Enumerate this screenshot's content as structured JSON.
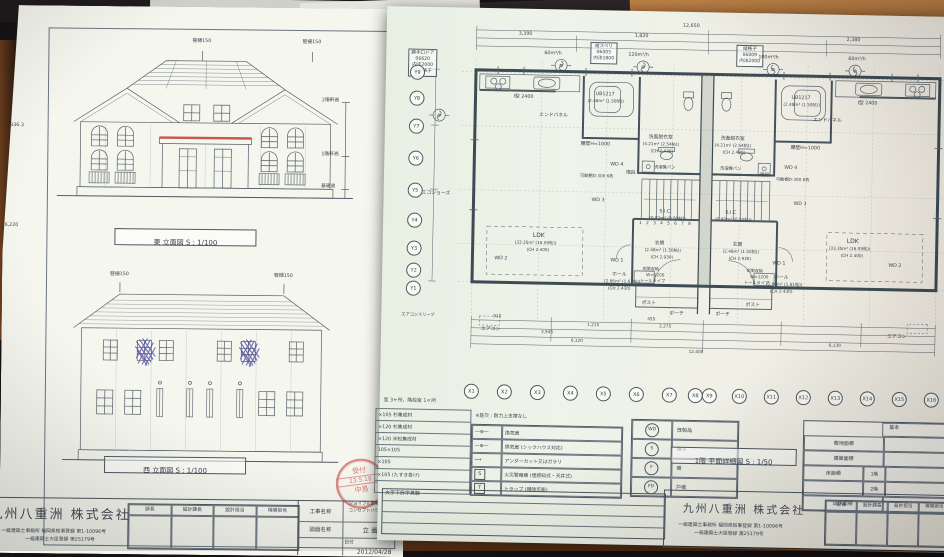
{
  "left": {
    "levels": {
      "lv1": "6,336.3",
      "lv2": "6,220"
    },
    "downspout": "竪樋150",
    "east_title": "東  立面図   S : 1/100",
    "west_title": "西  立面図   S : 1/100",
    "h2": "2階軒高",
    "h1": "1階軒高",
    "hb": "基礎高",
    "stamp": {
      "l1": "受付",
      "l2": "23.5.18",
      "l3": "中島"
    },
    "tb": {
      "company": "九州八重洲 株式会社",
      "reg1": "一級建築士事務所  福岡県知事登録  第1-10096号",
      "reg2": "一級建築士大臣登録  第25179号",
      "r1": "部長",
      "r2": "設計課長",
      "r3": "設計担当",
      "r4": "現場担当",
      "pl": "工事名称",
      "p1": "ジョイフル新築",
      "p1h": "東欧の丘",
      "p2": "コンセプトハウス",
      "p2h": "NO 27",
      "dl": "図面名称",
      "dn": "立 面 図",
      "datel": "日付",
      "date": "2012/04/28"
    }
  },
  "right": {
    "plan_title": "1階  平面詳細図  S : 1/50",
    "gx": [
      "X1",
      "X2",
      "X3",
      "X4",
      "X5",
      "X6",
      "X7",
      "X8",
      "X9",
      "X10",
      "X11",
      "X12",
      "X13",
      "X14",
      "X15",
      "X16"
    ],
    "gy": [
      "Y9",
      "Y8",
      "Y7",
      "Y6",
      "Y5",
      "Y4",
      "Y3",
      "Y2",
      "Y1"
    ],
    "dims": {
      "total_top": "12,650",
      "t1": "3,390",
      "t2": "1,820",
      "t3": "2,380",
      "b1": "910",
      "b2": "455",
      "b3": "1,215",
      "b4": "2,275",
      "b5": "3,945",
      "b6": "6,120",
      "b7": "6,130",
      "total_bottom": "12,400"
    },
    "flow": {
      "f60": "60m³/h",
      "f100": "100m³/h",
      "f120": "120m³/h"
    },
    "spec1": [
      "勝手口ドア",
      "06620",
      "内法2000",
      "縦手格子"
    ],
    "spec2": [
      "縦スベリ",
      "06005",
      "内法1800"
    ],
    "spec3": [
      "縦格子",
      "06009",
      "内法2000"
    ],
    "rooms": {
      "endpanel": "エンドパネル",
      "kitchen": "I型 2400",
      "koshikabe": "腰壁H=1000",
      "ub": "UB1217",
      "ub_a": "(2.48m² (1.50帖))",
      "kadou": "可動棚D-300 6枚",
      "senmen": "洗面脱衣室",
      "senmen_a": "(4.21m² (2.54帖))",
      "senmen_b": "(CH 2.430)",
      "sentaku": "洗濯機パン",
      "sic": "S.I.C",
      "sic_a": "(0.82m² (0.50帖))",
      "kaidan": "階段",
      "ldk": "LDK",
      "ldk_a": "(33.35m² (16.09帖))",
      "ldk_b": "(CH 2.400)",
      "genkan": "玄関",
      "genkan_a": "(2.48m² (1.50帖))",
      "genkan_b": "(CH 2.930)",
      "hall": "ホール",
      "hall_a": "(2.66m² (1.61帖))",
      "hall_b": "(CH 2.430)",
      "shuno": "玄関収納",
      "shuno_a": "W=1200",
      "shuno_b": "トールタイプ",
      "post": "ポスト",
      "porch": "ポーチ",
      "eco": "エコジョーズ",
      "sleeve": "エアコンスリーブ",
      "aircon": "エアコン",
      "wd1": "WD 1",
      "wd2": "WD 2",
      "wd3": "WD 3",
      "wd4": "WD 4"
    },
    "stair_nums": "1 2 3 4 5 6 7 8",
    "materials": {
      "note": "室 3ヶ所、階段室 1ヶ所",
      "rows": [
        "×105 杉集成材",
        "×120 杉集成材",
        "×120 米松集成材",
        "105×105",
        "×105",
        "×105 (たすき掛け)"
      ]
    },
    "legend": {
      "note": "※筋交 : 耐力上支障なし",
      "v1": "換気扇",
      "v2": "換気扇 (シックハウス対応)",
      "v3": "アンダーカット又はガラリ",
      "v4": "火災警報器 (煙感知式・天井式)",
      "v5": "トラップ (掃除可能)",
      "sym4": "S",
      "sym5": "T",
      "d1s": "WD",
      "d1": "既製品",
      "d2s": "S",
      "d2": "障子",
      "d3s": "F",
      "d3": "襖",
      "d4s": "FD",
      "d4": "戸襖"
    },
    "area": {
      "header": "基本",
      "a1": "敷地面積",
      "a2": "建築面積",
      "a3": "床面積",
      "a3a": "1階",
      "a3b": "2階",
      "a4": "延床面積"
    },
    "addr": "大字下府字真験",
    "tb": {
      "company": "九州八重洲 株式会社",
      "reg1": "一級建築士事務所  福岡県知事登録  第1-10096号",
      "reg2": "一級建築士大臣登録  第25179号",
      "r1": "部長",
      "r2": "設計課長",
      "r3": "設計担当",
      "r4": "現場担当",
      "pl": "工事名称",
      "dl": "図面名称"
    }
  }
}
